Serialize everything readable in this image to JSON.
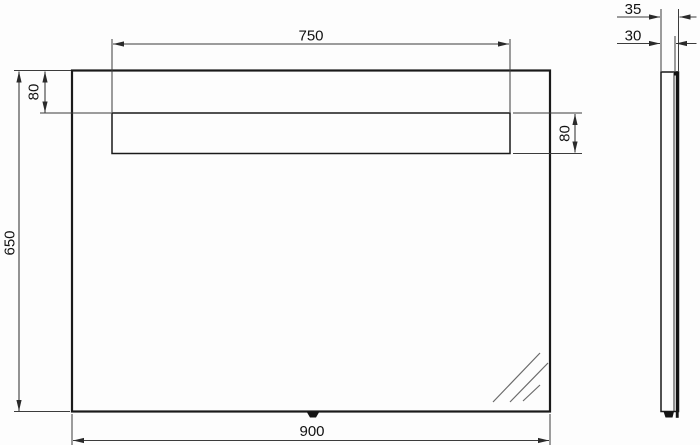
{
  "drawing": {
    "kind": "dimensioned elevation drawing",
    "views": {
      "front": "front elevation",
      "side": "side elevation"
    }
  },
  "dimensions": {
    "front": {
      "overall_width": "900",
      "overall_height": "650",
      "strip_width": "750",
      "strip_top_offset": "80",
      "strip_height": "80"
    },
    "side": {
      "total_depth": "35",
      "body_depth": "30"
    }
  },
  "colors": {
    "background": "#fdfdfd",
    "outline": "#1a1a1a",
    "dimension_lines": "#3c3c3c",
    "glass_hatch": "#6a6a6a"
  }
}
